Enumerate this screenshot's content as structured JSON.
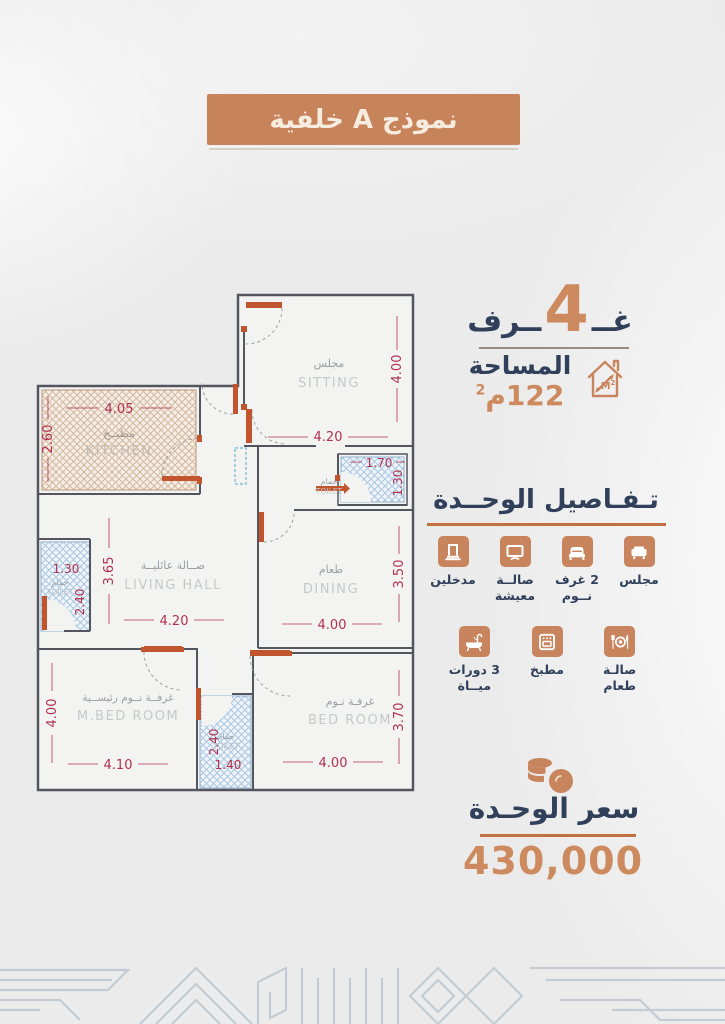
{
  "badge": {
    "text": "نموذج A خلفية"
  },
  "summary": {
    "rooms": {
      "prefix": "غــ",
      "count": "4",
      "suffix": "ــرف"
    },
    "area": {
      "label": "المساحة",
      "value": "122م",
      "sup": "2",
      "icon_text": "M",
      "icon_sup": "2"
    }
  },
  "details": {
    "title": "تـفـاصيل الوحــدة",
    "row1": [
      {
        "icon": "majlis-sofa-icon",
        "label": "مجلس"
      },
      {
        "icon": "bedrooms-bed-icon",
        "label": "2 غرف\nنــوم"
      },
      {
        "icon": "living-tv-icon",
        "label": "صالــة\nمعيشة"
      },
      {
        "icon": "entrances-door-icon",
        "label": "مدخلين"
      }
    ],
    "row2": [
      {
        "icon": "dining-plate-icon",
        "label": "صالـة\nطعام"
      },
      {
        "icon": "kitchen-oven-icon",
        "label": "مطبخ"
      },
      {
        "icon": "bathrooms-tub-icon",
        "label": "3 دورات\nميــاة"
      }
    ]
  },
  "price": {
    "label": "سعر الوحـدة",
    "value": "430,000"
  },
  "floorplan": {
    "rooms": [
      {
        "ar": "مجلس",
        "en": "SITTING",
        "w": "4.20",
        "h": "4.00"
      },
      {
        "ar": "مطبــخ",
        "en": "KITCHEN",
        "w": "4.05",
        "h": "2.60"
      },
      {
        "ar": "حمام",
        "en": "TOILET",
        "w": "1.70",
        "h": "1.30"
      },
      {
        "ar": "صــالة عائليــة",
        "en": "LIVING HALL",
        "w": "4.20",
        "h": "3.65"
      },
      {
        "ar": "حمام",
        "en": "TOILET",
        "w": "1.30",
        "h": "2.40"
      },
      {
        "ar": "طعام",
        "en": "DINING",
        "w": "4.00",
        "h": "3.50"
      },
      {
        "ar": "غرفــة نــوم رئيســية",
        "en": "M.BED ROOM",
        "w": "4.10",
        "h": "4.00"
      },
      {
        "ar": "حمام",
        "en": "TOILET",
        "w": "1.40",
        "h": "2.40"
      },
      {
        "ar": "غرفـة نـوم",
        "en": "BED ROOM",
        "w": "4.00",
        "h": "3.70"
      }
    ]
  },
  "colors": {
    "accent_orange": "#c8845c",
    "navy": "#31405a",
    "dimension_red": "#b23050",
    "door_orange": "#c2542e",
    "hatch_blue": "#a9c6e0",
    "hatch_tan": "#d3b79c",
    "pattern_blue": "#c3ccd4"
  }
}
